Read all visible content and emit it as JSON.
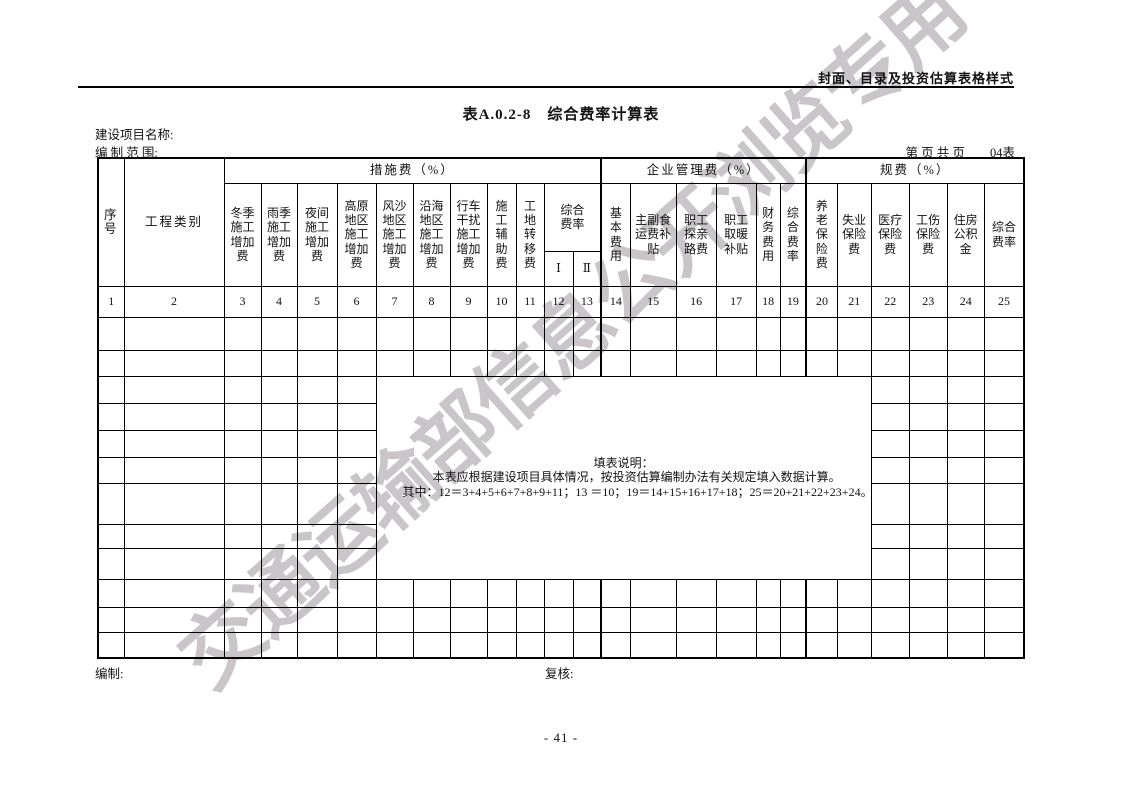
{
  "page": {
    "header_note": "封面、目录及投资估算表格样式",
    "title": "表A.0.2-8　综合费率计算表",
    "project_name_label": "建设项目名称:",
    "scope_label": "编 制 范 围:",
    "page_info": "第 页 共 页",
    "table_no": "04表",
    "page_number": "- 41 -",
    "watermark": "交通运输部信息公开浏览专用"
  },
  "table": {
    "corner": {
      "seq": "序\n号",
      "category": "工程类别"
    },
    "measures": {
      "label": "措施费（%）",
      "cols": [
        "冬季\n施工\n增加\n费",
        "雨季\n施工\n增加\n费",
        "夜间\n施工\n增加\n费",
        "高原\n地区\n施工\n增加\n费",
        "风沙\n地区\n施工\n增加\n费",
        "沿海\n地区\n施工\n增加\n费",
        "行车\n干扰\n施工\n增加\n费",
        "施\n工\n辅\n助\n费",
        "工\n地\n转\n移\n费"
      ],
      "composite": {
        "label": "综合\n费率",
        "sub": [
          "Ⅰ",
          "Ⅱ"
        ]
      }
    },
    "management": {
      "label": "企业管理费（%）",
      "cols": [
        "基\n本\n费\n用",
        "主副食\n运费补\n贴",
        "职工\n探亲\n路费",
        "职工\n取暖\n补贴",
        "财\n务\n费\n用",
        "综\n合\n费\n率"
      ]
    },
    "fees": {
      "label": "规费（%）",
      "cols": [
        "养\n老\n保\n险\n费",
        "失业\n保险\n费",
        "医疗\n保险\n费",
        "工伤\n保险\n费",
        "住房\n公积\n金",
        "综合\n费率"
      ]
    },
    "column_numbers": [
      "1",
      "2",
      "3",
      "4",
      "5",
      "6",
      "7",
      "8",
      "9",
      "10",
      "11",
      "12",
      "13",
      "14",
      "15",
      "16",
      "17",
      "18",
      "19",
      "20",
      "21",
      "22",
      "23",
      "24",
      "25"
    ],
    "note": {
      "title": "填表说明：",
      "line1": "本表应根据建设项目具体情况，按投资估算编制办法有关规定填入数据计算。",
      "line2": "其中：12＝3+4+5+6+7+8+9+11；13 ＝10；19＝14+15+16+17+18；25＝20+21+22+23+24。"
    },
    "footer": {
      "prepared_label": "编制:",
      "checked_label": "复核:"
    }
  }
}
